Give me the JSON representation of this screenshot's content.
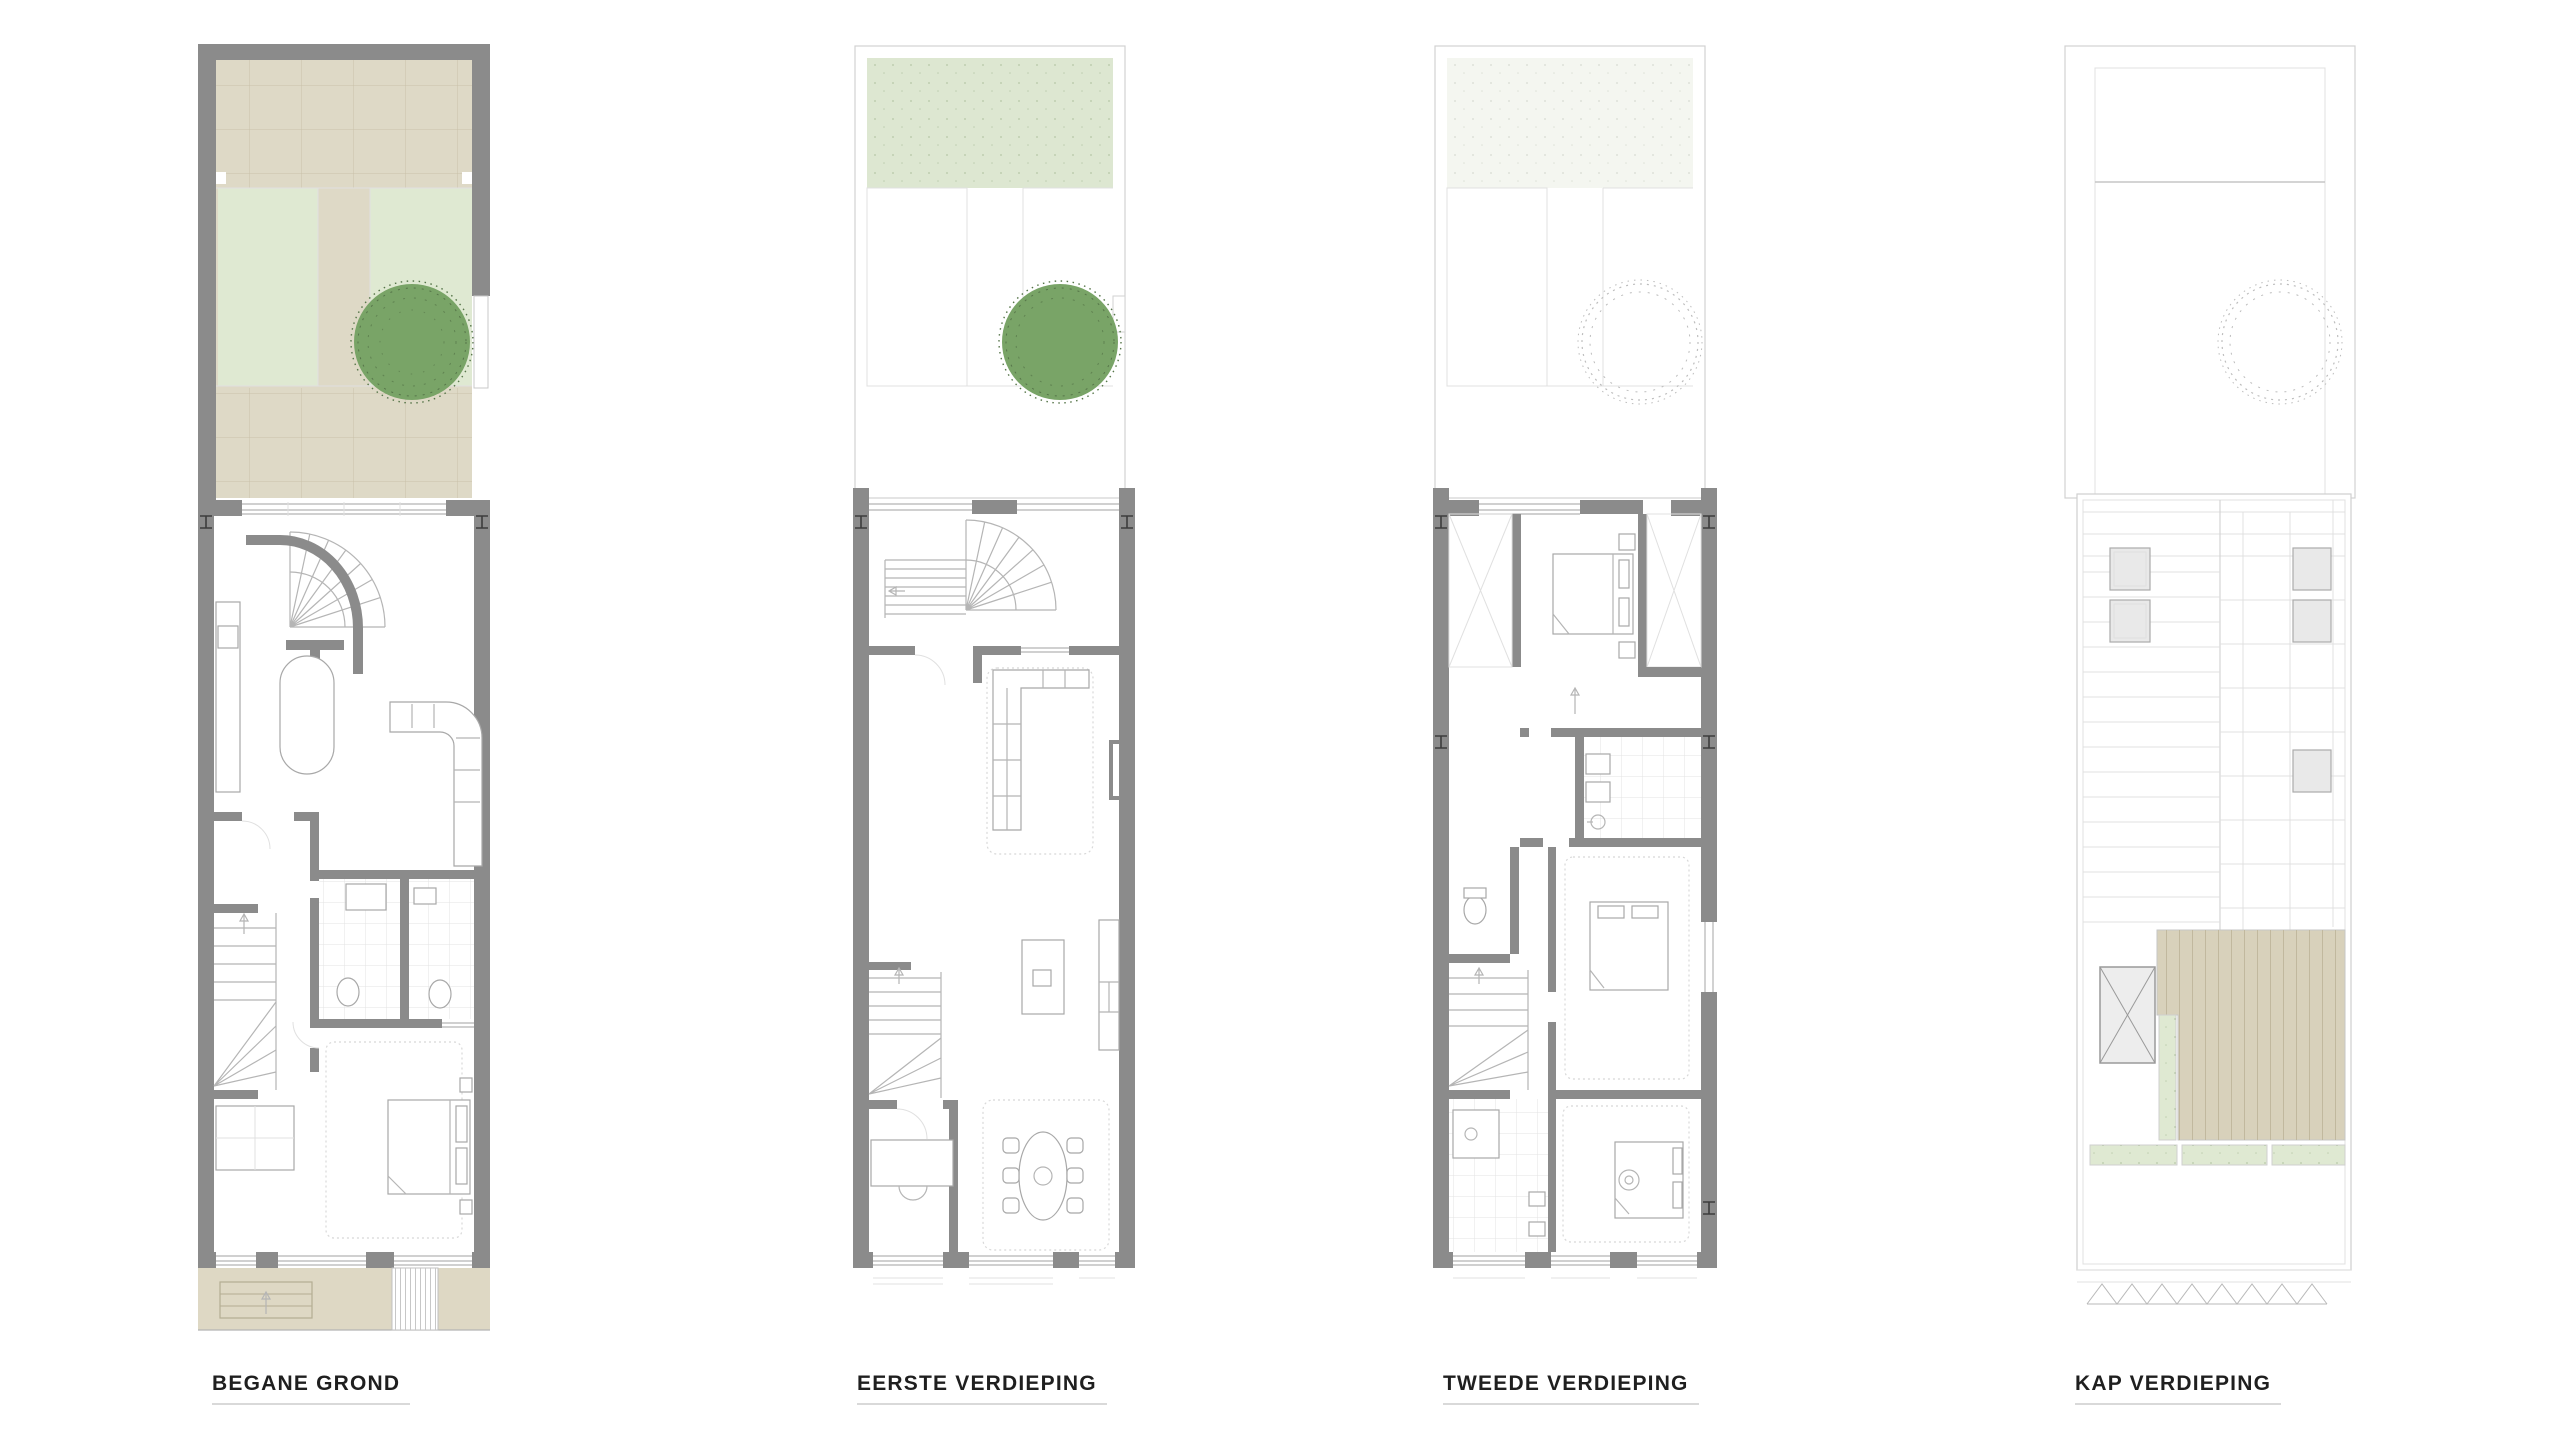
{
  "sheet": {
    "type": "architectural floor plan set",
    "background": "#ffffff",
    "floor_count": 4
  },
  "plans": [
    {
      "id": "begane-grond",
      "label": "BEGANE GROND",
      "features": [
        "garden-paving",
        "lawn",
        "tree",
        "garden-wall",
        "spiral-stair",
        "kitchen-counter",
        "corner-sofa",
        "bathroom",
        "toilet",
        "straight-stair",
        "bedroom",
        "bed",
        "closet",
        "street-sidewalk",
        "entry-steps",
        "cellar-hatch"
      ]
    },
    {
      "id": "eerste-verdieping",
      "label": "EERSTE VERDIEPING",
      "features": [
        "green-roof-strip",
        "tree",
        "spiral-stair",
        "straight-stair",
        "living-room",
        "corner-sofa",
        "rug",
        "fireplace-niche",
        "kitchen-island",
        "kitchen-counter",
        "dining-table",
        "dining-chairs",
        "desk-room"
      ]
    },
    {
      "id": "tweede-verdieping",
      "label": "TWEEDE VERDIEPING",
      "features": [
        "tree-outline",
        "master-bedroom",
        "bed",
        "wardrobes",
        "bathroom",
        "double-washbasin",
        "shower",
        "toilet",
        "straight-stair",
        "bedroom-2",
        "bedroom-3",
        "shower-room"
      ]
    },
    {
      "id": "kap-verdieping",
      "label": "KAP VERDIEPING",
      "features": [
        "tree-outline",
        "sloped-roof-panels",
        "skylights",
        "roof-window",
        "roof-terrace-decking",
        "planters",
        "eave-detail"
      ]
    }
  ],
  "colors": {
    "bg": "#ffffff",
    "wall": "#8b8b8b",
    "tile": "#ded9c6",
    "tile-line": "#c9c1a9",
    "grass": "#dfe9d2",
    "grass-band": "#dde7d1",
    "tree": "#79a467",
    "tree-dark": "#567549",
    "deck": "#d8d1bb",
    "deck-line": "#c1b89e",
    "pave": "#ded8c4",
    "skylight": "#e9e9e9",
    "ink": "#1f1f1f",
    "underline": "#d9d9d9"
  }
}
